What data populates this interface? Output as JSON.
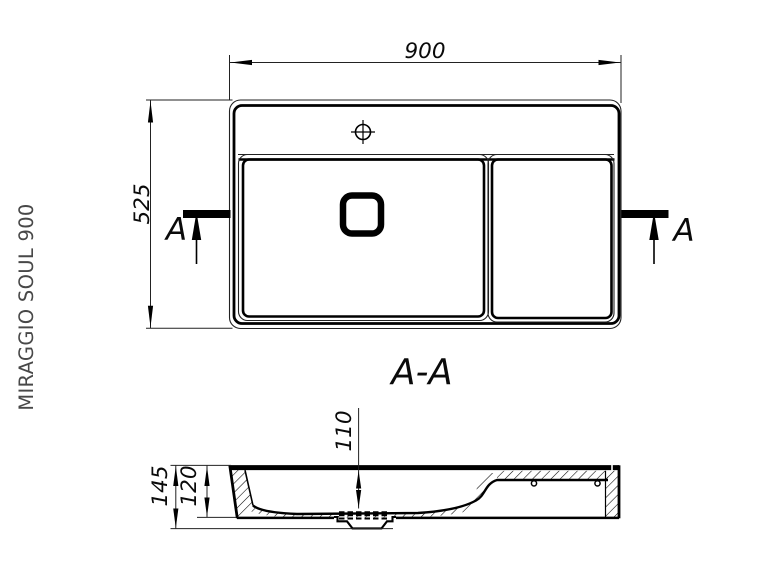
{
  "colors": {
    "background": "#ffffff",
    "line": "#000000",
    "thin_line": "#222222",
    "title_text": "#484848"
  },
  "title": "MIRAGGIO SOUL 900",
  "top_view": {
    "width_dim": "900",
    "depth_dim": "525",
    "cut_letter_left": "A",
    "cut_letter_right": "A"
  },
  "section_view": {
    "name": "A-A",
    "basin_depth_dim": "110",
    "rim_height_dim": "120",
    "total_height_dim": "145"
  }
}
